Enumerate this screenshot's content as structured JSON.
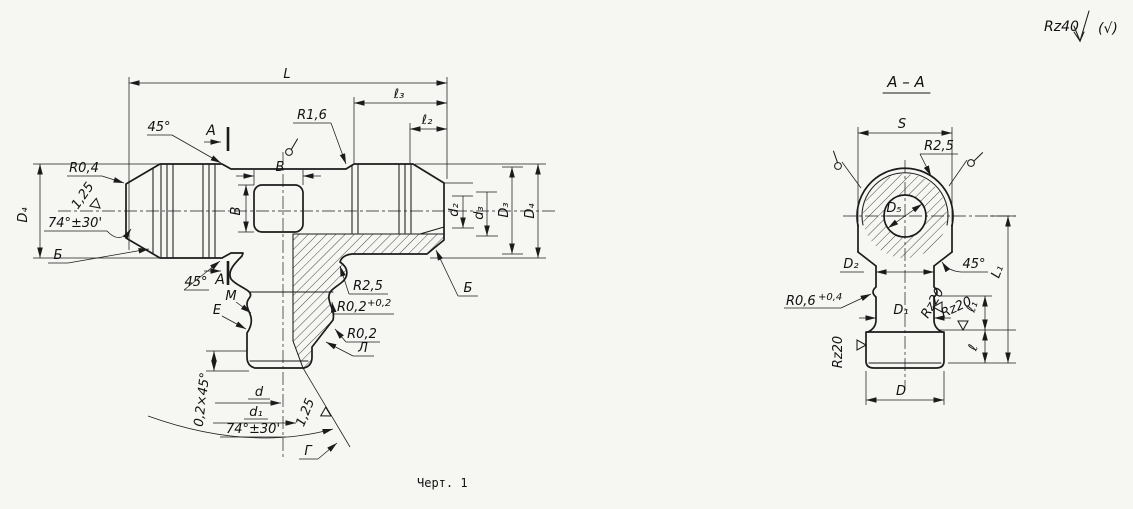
{
  "colors": {
    "ink": "#1b1b1b",
    "paper": "#f6f6f3"
  },
  "corner": {
    "roughness": "Rz40",
    "check": "(√)"
  },
  "caption": "Черт. 1",
  "main_view": {
    "length_dims": {
      "L": "L",
      "l3": "ℓ₃",
      "l2": "ℓ₂"
    },
    "top_labels": {
      "angle45": "45°",
      "section_a": "A",
      "r16": "R1,6"
    },
    "left_labels": {
      "r04": "R0,4",
      "finish125": "1,25",
      "angle74": "74°±30'",
      "cone_b": "Б",
      "d4": "D₄"
    },
    "socket": {
      "width": "В",
      "height": "В"
    },
    "branch_labels": {
      "angle45": "45°",
      "section_a": "A",
      "m": "М",
      "e": "Е",
      "r25": "R2,5",
      "r02_base": "R0,2",
      "r02_tol": "+0,2",
      "r02b": "R0,2",
      "l_surf": "Л",
      "chamfer": "0,2×45°",
      "d": "d",
      "d1": "d₁",
      "angle74": "74°±30'",
      "finish125": "1,25",
      "g_surf": "Г"
    },
    "right_dims": {
      "d2": "d₂",
      "d3": "d₃",
      "D3": "D₃",
      "D4": "D₄",
      "b_surf": "Б"
    }
  },
  "section_view": {
    "title": "А – А",
    "labels": {
      "S": "S",
      "r25": "R2,5",
      "D5": "D₅",
      "D2": "D₂",
      "angle45": "45°",
      "L1": "L₁",
      "r06_base": "R0,6",
      "r06_tol": "+0,4",
      "D1": "D₁",
      "rz20_a": "Rz20",
      "rz20_b": "Rz20",
      "rz20_c": "Rz20",
      "l1": "ℓ₁",
      "l": "ℓ",
      "D": "D"
    }
  }
}
